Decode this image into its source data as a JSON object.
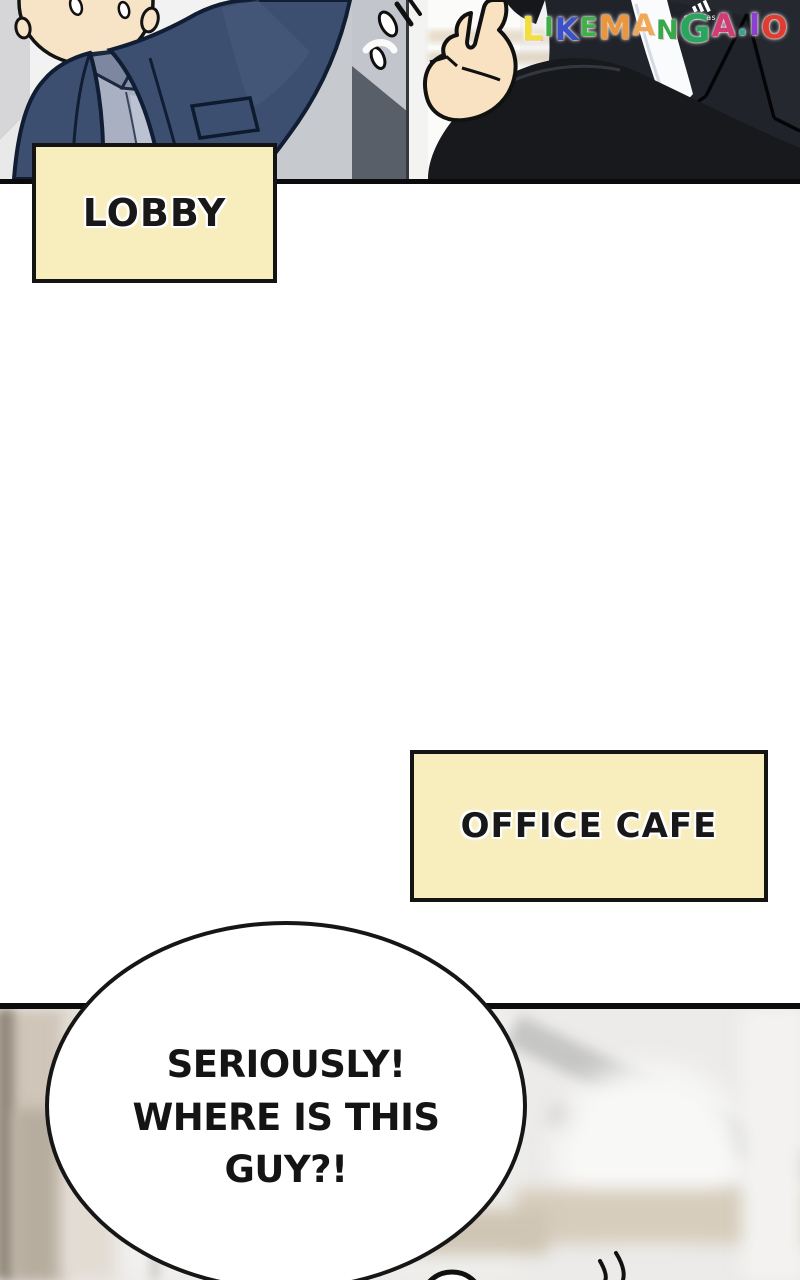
{
  "labels": {
    "lobby": "LOBBY",
    "office_cafe": "OFFICE CAFE"
  },
  "bubble": {
    "lines": [
      "SERIOUSLY!",
      "WHERE IS THIS",
      "GUY?!"
    ]
  },
  "watermark": {
    "text": "LIKEMANGA.IO",
    "letters": [
      {
        "ch": "L",
        "style": "color:#f2de3c;font-size:33px;top:3px"
      },
      {
        "ch": "I",
        "style": "color:#3cb047;font-size:26px;top:-1px"
      },
      {
        "ch": "K",
        "style": "color:#3c51c9;font-size:31px;top:3px"
      },
      {
        "ch": "E",
        "style": "color:#3eb14b;font-size:26px;top:-1px"
      },
      {
        "ch": "M",
        "style": "color:#ea963e;font-size:33px;top:2px"
      },
      {
        "ch": "A",
        "style": "color:#f0a855;font-size:29px;top:-2px"
      },
      {
        "ch": "N",
        "style": "color:#38a84b;font-size:27px;top:2px"
      },
      {
        "ch": "G",
        "style": "color:#28a55e;font-size:38px;top:5px"
      },
      {
        "ch": "A",
        "style": "color:#d23b73;font-size:31px;top:-1px"
      },
      {
        "ch": ".",
        "style": "color:#2aa99b;font-size:30px;top:-2px"
      },
      {
        "ch": "I",
        "style": "color:#8b40d1;font-size:30px;top:-2px"
      },
      {
        "ch": "O",
        "style": "color:#e23b2f;font-size:31px;top:1px"
      }
    ]
  },
  "panel1": {
    "sadidas_label": "sadidas"
  },
  "icons": {
    "sweat_drop": "sweat-drop-icon",
    "surprise_marks": "surprise-flinch-marks-icon",
    "thumb_gesture": "thumbs-up-hand-icon",
    "brand_parody": "sadidas-three-stripes-icon"
  },
  "colors": {
    "label_box_fill": "#f8edbc",
    "label_box_border": "#141414",
    "panel_border": "#0b0b0b",
    "bubble_fill": "#ffffff",
    "bubble_border": "#161616",
    "jacket_navy": "#3d4f70",
    "shirt_blue_grey": "#a8b0c2",
    "skin": "#f7e3c6",
    "suit_black": "#202329",
    "pillar_grey": "#c2c6cc"
  }
}
